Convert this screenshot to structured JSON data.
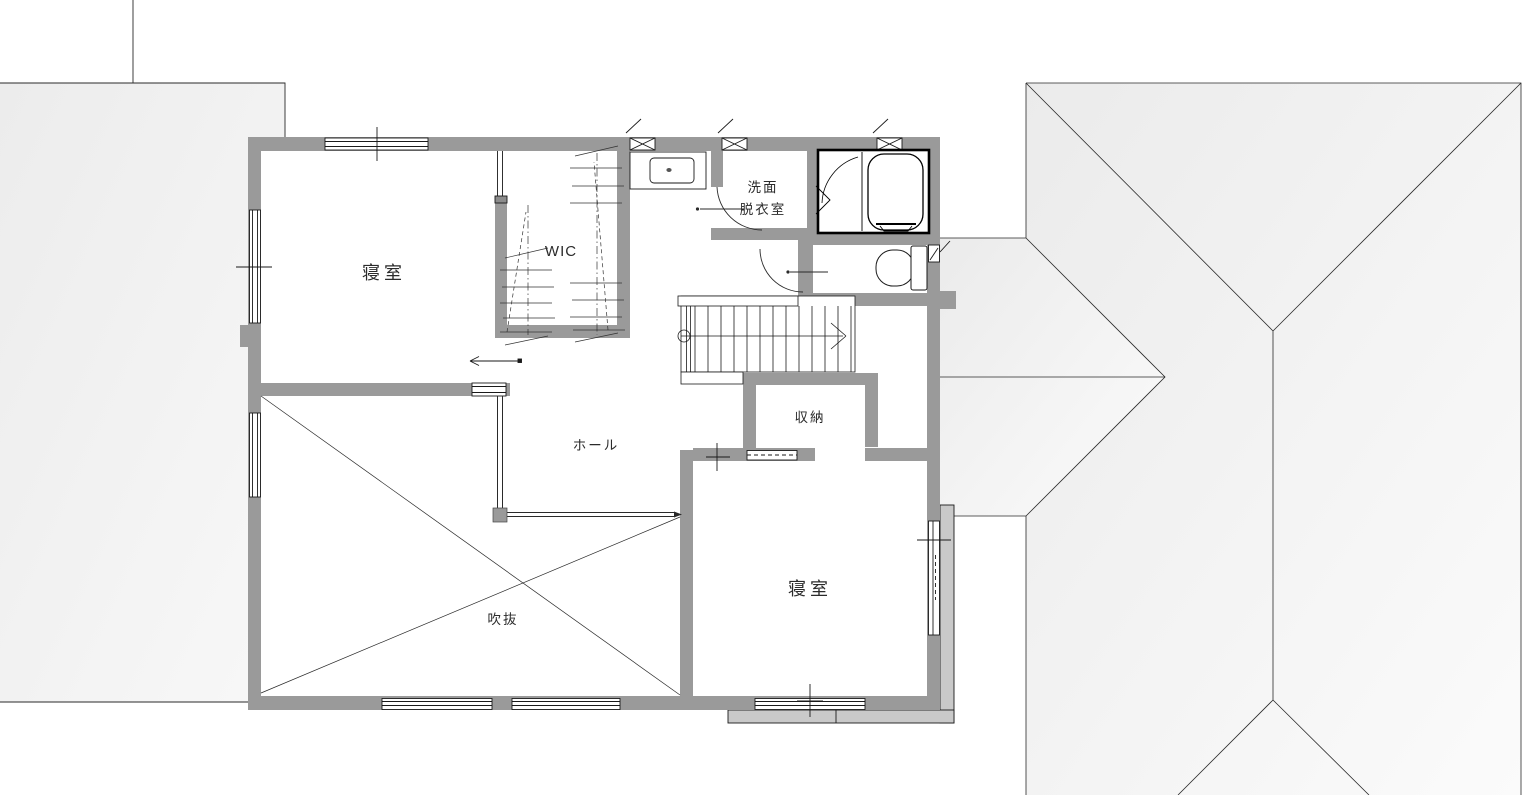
{
  "rooms": {
    "bedroom1": "寝室",
    "wic": "WIC",
    "washroom_line1": "洗面",
    "washroom_line2": "脱衣室",
    "hall": "ホール",
    "closet": "収納",
    "void": "吹抜",
    "bedroom2": "寝室"
  },
  "colors": {
    "wall": "#9a9a9a",
    "balcony": "#c9c9c9",
    "line": "#2a2a2a",
    "bath_border": "#000000"
  }
}
